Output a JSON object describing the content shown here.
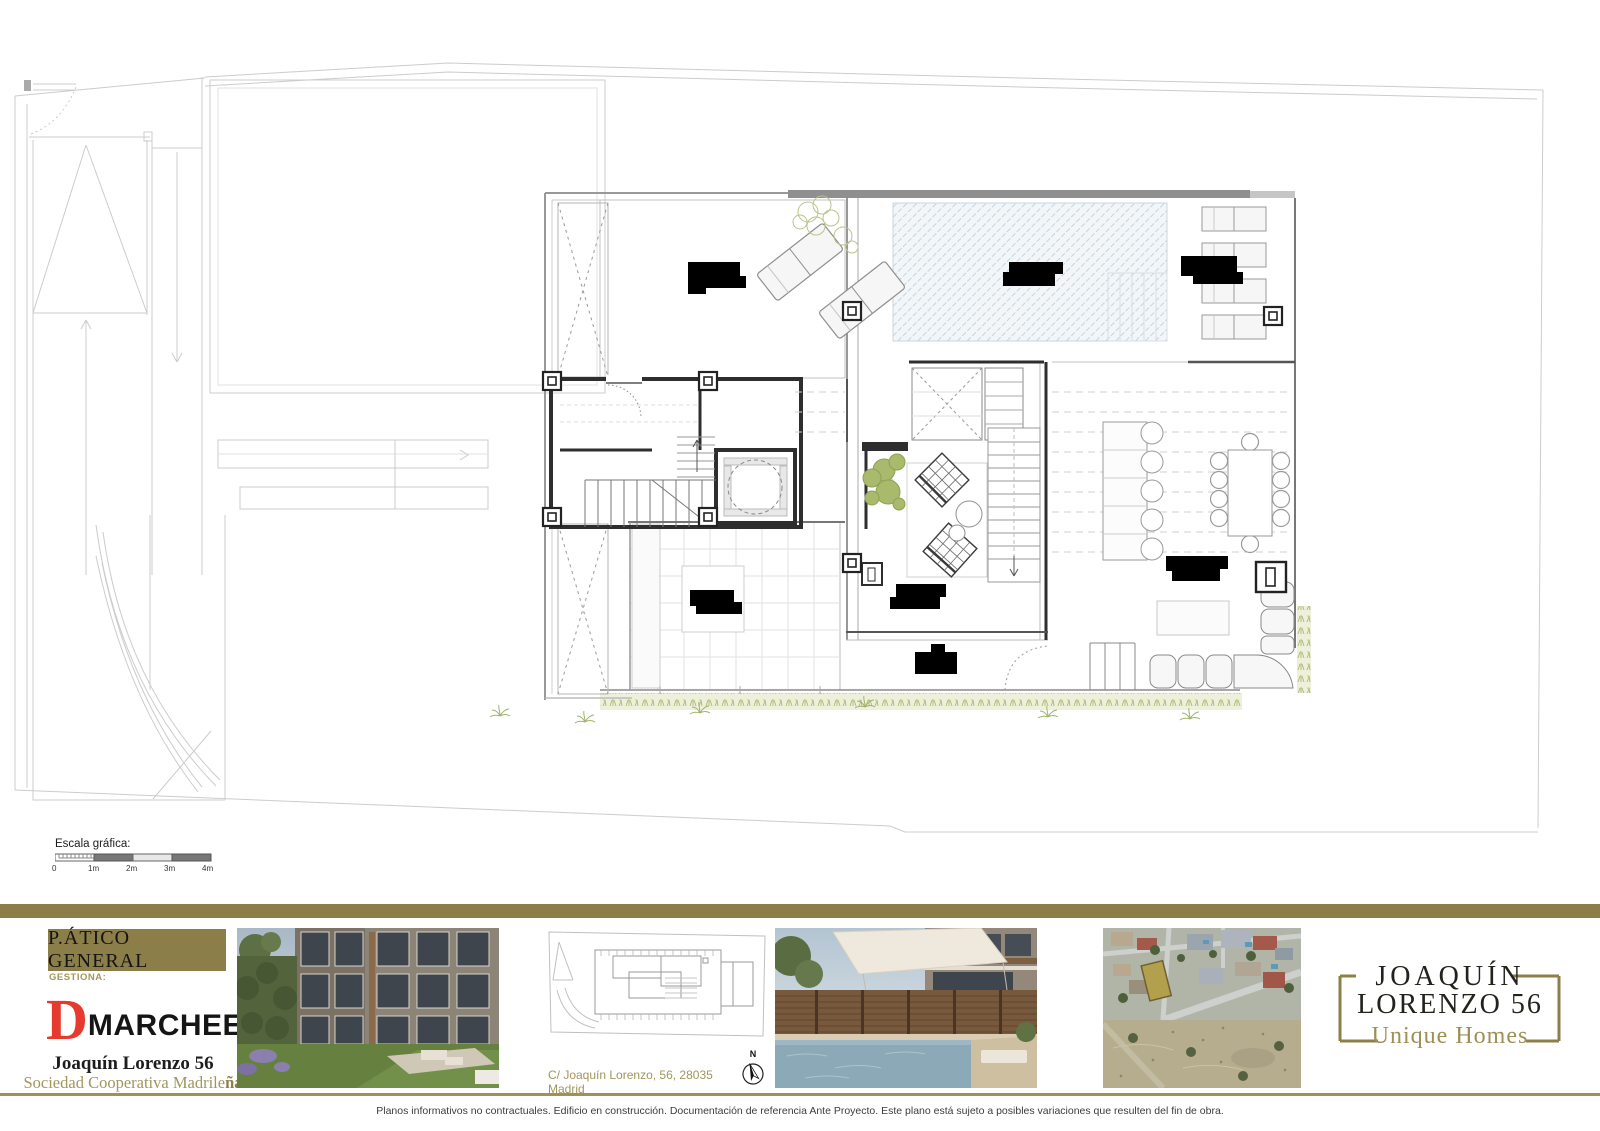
{
  "sheet": {
    "plan_title": "P.ÁTICO GENERAL",
    "disclaimer": "Planos informativos no contractuales. Edificio en construcción. Documentación de referencia Ante Proyecto. Este plano está sujeto a posibles variaciones que resulten del fin de obra."
  },
  "scale_bar": {
    "label": "Escala gráfica:",
    "ticks": [
      "0",
      "1m",
      "2m",
      "3m",
      "4m"
    ]
  },
  "manager": {
    "label": "GESTIONA:",
    "brand_initial": "D",
    "brand_name": "MARCHEE",
    "project_name": "Joaquín Lorenzo 56",
    "cooperative_regular": "Sociedad Cooperativa Madrile",
    "cooperative_bold": "ña"
  },
  "location": {
    "address": "C/ Joaquín Lorenzo, 56, 28035 Madrid",
    "north_label": "N"
  },
  "brand_logo": {
    "line1": "JOAQUÍN",
    "line2": "LORENZO 56",
    "tagline": "Unique Homes"
  },
  "colors": {
    "gold": "#8b7e49",
    "gold_text": "#a3955c",
    "brand_red": "#e8392e",
    "pool_hatch": "#c3d4de",
    "plant_green": "#a9ba6d",
    "redaction_black": "#000000"
  }
}
